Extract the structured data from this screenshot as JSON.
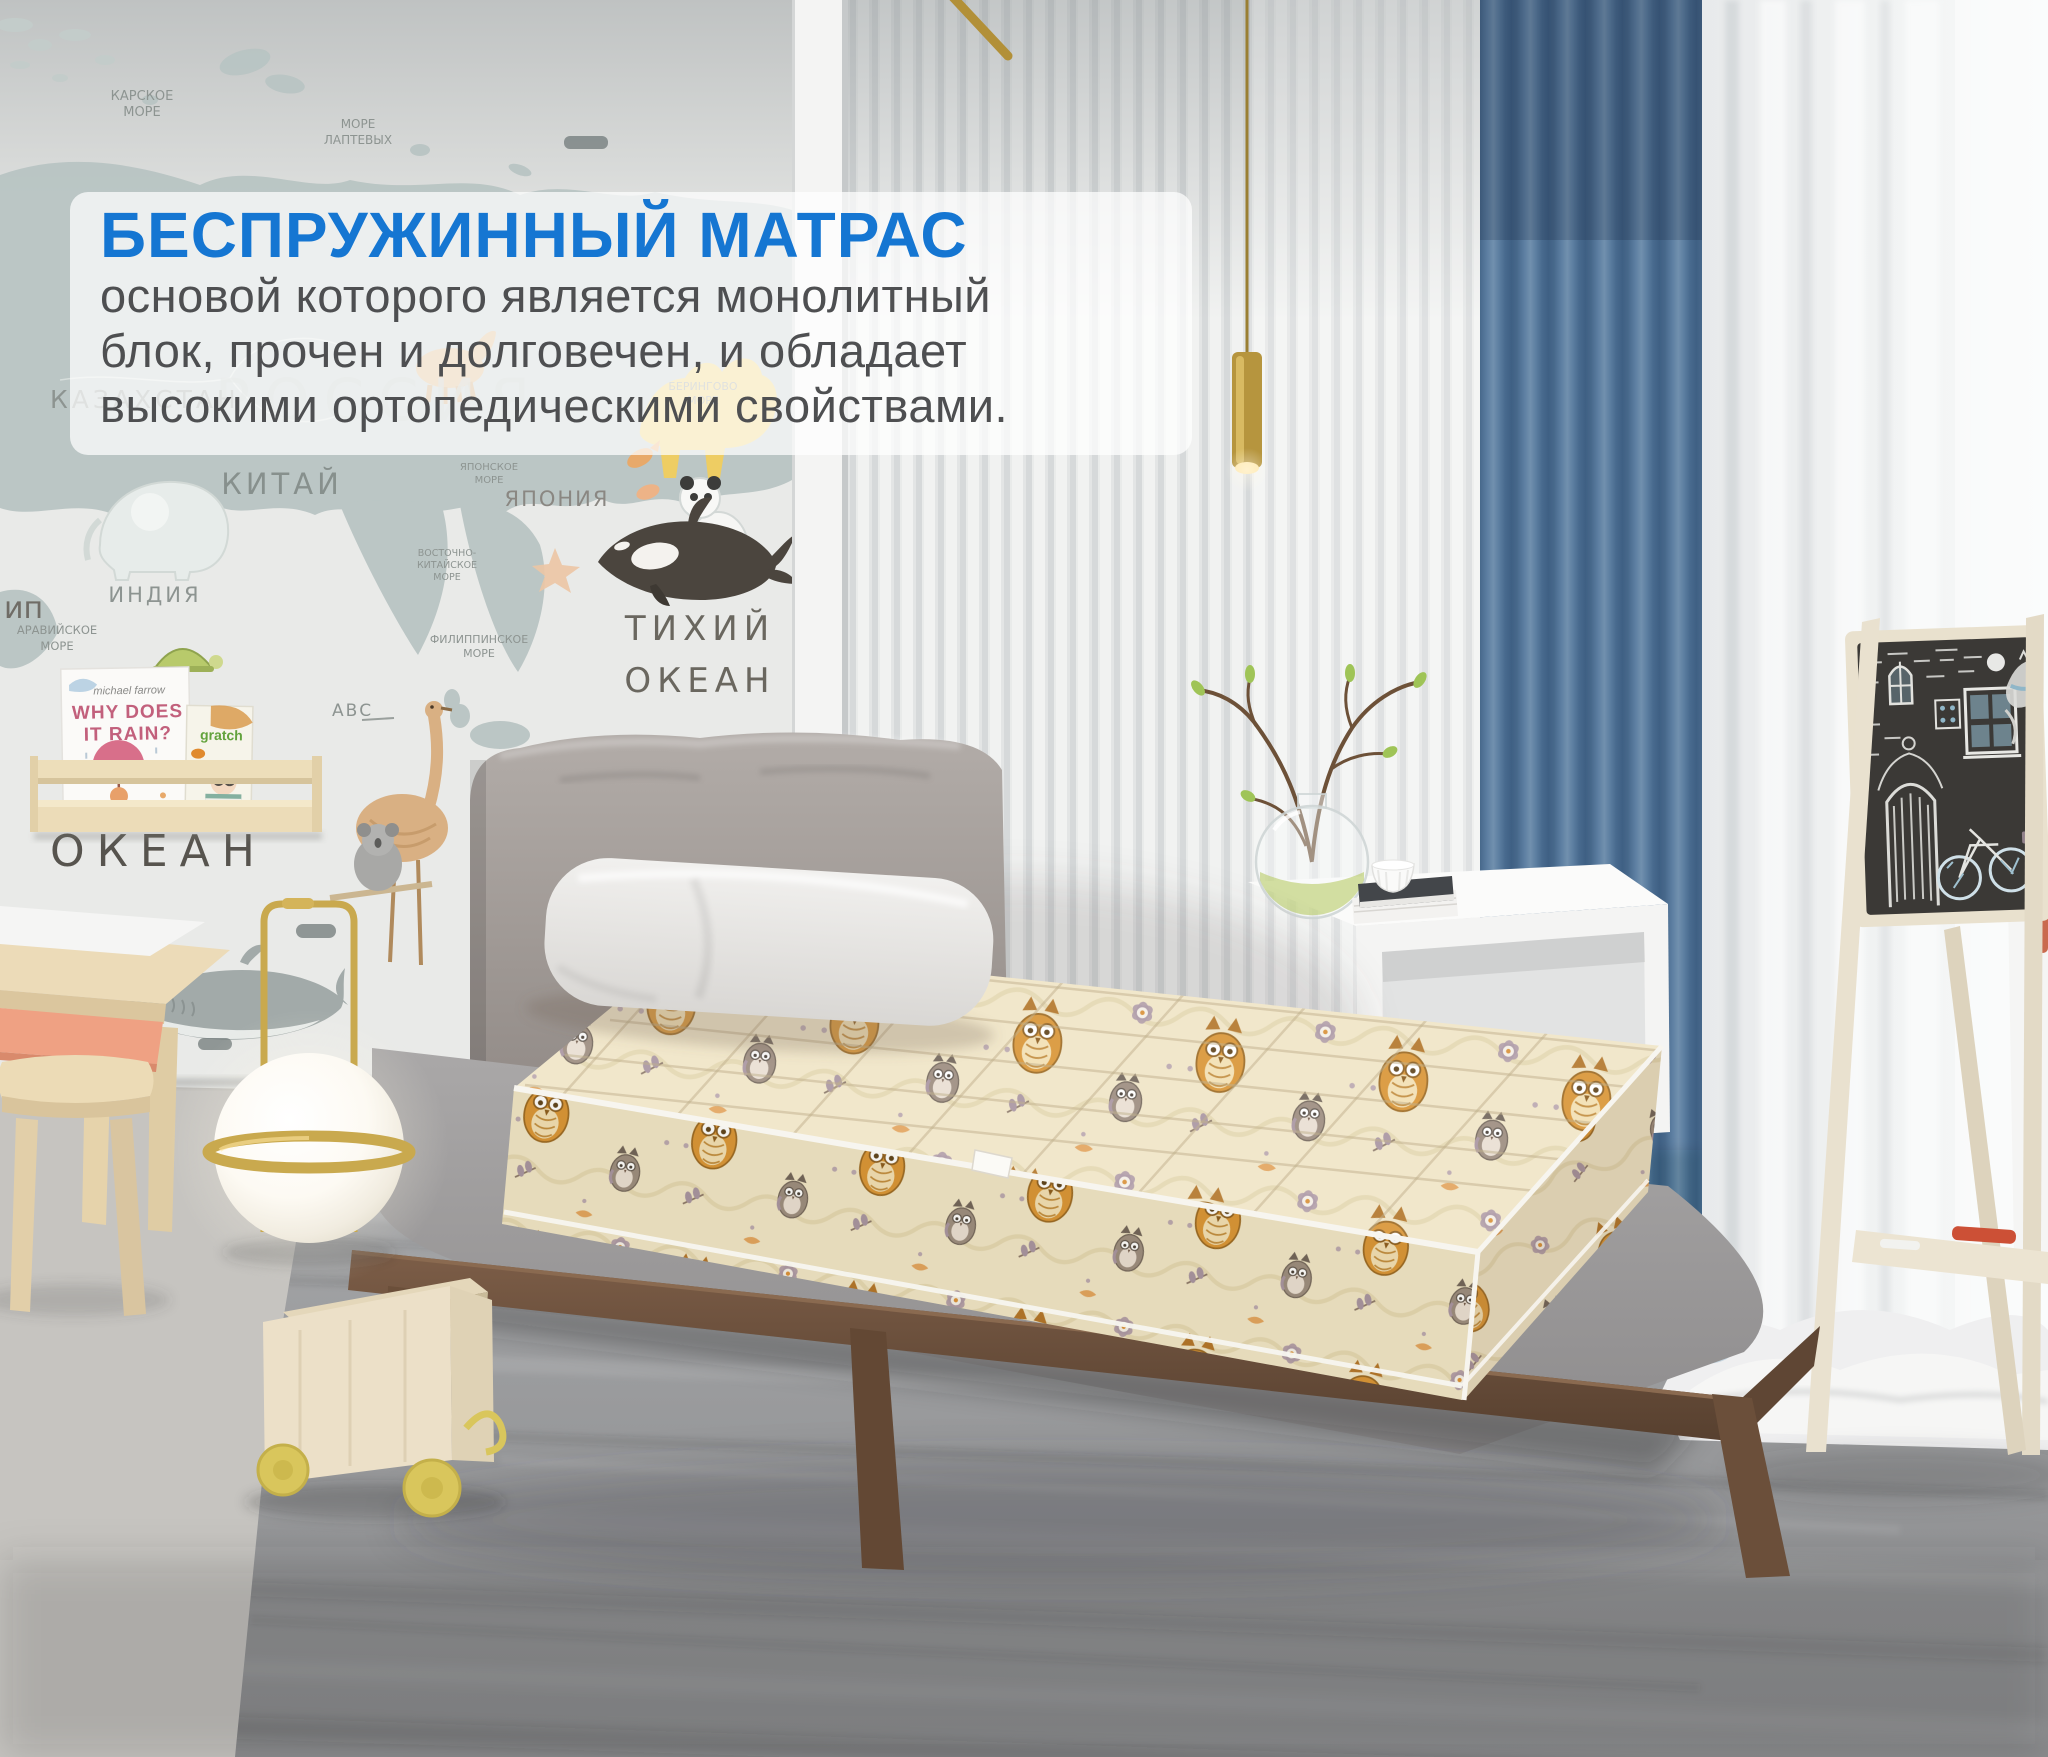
{
  "caption": {
    "title": "БЕСПРУЖИННЫЙ МАТРАС",
    "lines": [
      "основой которого является монолитный",
      "блок, прочен и долговечен, и обладает",
      "высокими ортопедическими свойствами."
    ],
    "title_color": "#1576d2",
    "body_color": "#4e4f51",
    "background": "rgba(255,255,255,0.72)"
  },
  "wall_labels": {
    "russia": "РОССИЯ",
    "kazakhstan": "КАЗАХСТАН",
    "china": "КИТАЙ",
    "india": "ИНДИЯ",
    "japan": "ЯПОНИЯ",
    "kara_sea_1": "КАРСКОЕ",
    "kara_sea_2": "МОРЕ",
    "laptev_sea_1": "МОРЕ",
    "laptev_sea_2": "ЛАПТЕВЫХ",
    "bering_sea_1": "БЕРИНГОВО",
    "bering_sea_2": "МОРЕ",
    "japan_sea_1": "ЯПОНСКОЕ",
    "japan_sea_2": "МОРЕ",
    "east_china_1": "ВОСТОЧНО-",
    "east_china_2": "КИТАЙСКОЕ",
    "east_china_3": "МОРЕ",
    "philippine_1": "ФИЛИППИНСКОЕ",
    "philippine_2": "МОРЕ",
    "arabian_1": "АРАВИЙСКОЕ",
    "arabian_2": "МОРЕ",
    "pacific_1": "ТИХИЙ",
    "pacific_2": "ОКЕАН",
    "ocean": "ОКЕАН",
    "edge_partial": "ип",
    "abc_partial": "АВС"
  },
  "books": {
    "book1_author": "michael farrow",
    "book1_title_1": "WHY DOES",
    "book1_title_2": "IT RAIN?",
    "book2_title": "gratch"
  },
  "colors": {
    "accent_blue_title": "#1576d2",
    "curtain_blue": "#57789b",
    "mattress_beige": "#f0e5c6",
    "owl_orange": "#d99433",
    "wood_walnut": "#6b4f3a",
    "wood_birch": "#ecdfc2",
    "wall_map_land": "#b9c4c3",
    "rug_gray": "#97989a",
    "lamp_gold": "#c9a94e"
  }
}
